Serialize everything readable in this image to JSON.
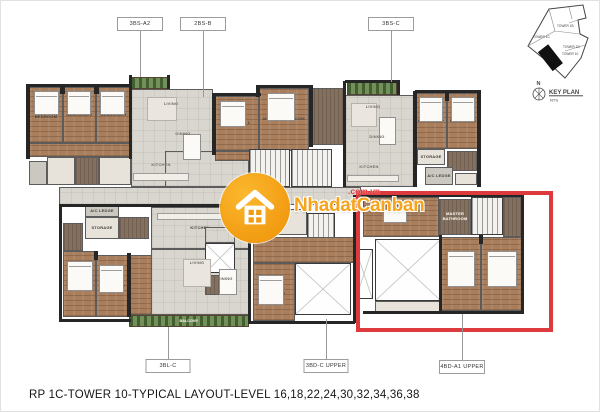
{
  "title": "RP 1C-TOWER 10-TYPICAL LAYOUT-LEVEL 16,18,22,24,30,32,34,36,38",
  "watermark": {
    "name": "NhadatCanban",
    "domain": ".com.vn",
    "circle_color": "#F29C12",
    "text_color": "#F6A41C",
    "domain_color": "#E43438"
  },
  "keyplan": {
    "north": "N",
    "label": "KEY PLAN",
    "scale": "NTS",
    "towers": [
      "TOWER 1B",
      "TOWER 1C",
      "TOWER 1D",
      "TOWER 10"
    ]
  },
  "highlight": {
    "x": 355,
    "y": 190,
    "w": 197,
    "h": 141,
    "color": "#DC3A3D",
    "unit": "4BD-A1 UPPER"
  },
  "unit_labels": [
    {
      "text": "3BS-A2",
      "cx": 139,
      "y": 16,
      "w": 46,
      "h": 14
    },
    {
      "text": "2BS-B",
      "cx": 202,
      "y": 16,
      "w": 46,
      "h": 14
    },
    {
      "text": "3BS-C",
      "cx": 390,
      "y": 16,
      "w": 46,
      "h": 14
    },
    {
      "text": "3BL-C",
      "cx": 167,
      "y": 358,
      "w": 45,
      "h": 14
    },
    {
      "text": "3BD-C UPPER",
      "cx": 325,
      "y": 358,
      "w": 45,
      "h": 14
    },
    {
      "text": "4BD-A1 UPPER",
      "cx": 461,
      "y": 359,
      "w": 46,
      "h": 14
    }
  ],
  "leaders": [
    {
      "x": 139,
      "y1": 30,
      "y2": 76
    },
    {
      "x": 202,
      "y1": 30,
      "y2": 96
    },
    {
      "x": 390,
      "y1": 30,
      "y2": 81
    },
    {
      "x": 167,
      "y1": 326,
      "y2": 358
    },
    {
      "x": 325,
      "y1": 318,
      "y2": 358
    },
    {
      "x": 461,
      "y1": 313,
      "y2": 359
    }
  ],
  "plan": {
    "rooms": [
      {
        "x": 130,
        "y": 76,
        "w": 38,
        "h": 12,
        "type": "balcony"
      },
      {
        "x": 200,
        "y": 101,
        "w": 16,
        "h": 11,
        "type": "balcony"
      },
      {
        "x": 346,
        "y": 81,
        "w": 50,
        "h": 13,
        "type": "balcony"
      },
      {
        "x": 128,
        "y": 314,
        "w": 120,
        "h": 12,
        "type": "balcony",
        "label": "BALCONY"
      },
      {
        "x": 130,
        "y": 88,
        "w": 82,
        "h": 98,
        "type": "tile"
      },
      {
        "x": 344,
        "y": 94,
        "w": 70,
        "h": 92,
        "type": "tile"
      },
      {
        "x": 164,
        "y": 150,
        "w": 84,
        "h": 36,
        "type": "tile"
      },
      {
        "x": 58,
        "y": 186,
        "w": 302,
        "h": 18,
        "type": "tile"
      },
      {
        "x": 150,
        "y": 206,
        "w": 98,
        "h": 42,
        "type": "tile",
        "label": "KITCHEN"
      },
      {
        "x": 150,
        "y": 248,
        "w": 98,
        "h": 66,
        "type": "tile"
      },
      {
        "x": 204,
        "y": 226,
        "w": 30,
        "h": 16,
        "type": "tile"
      },
      {
        "x": 28,
        "y": 86,
        "w": 34,
        "h": 56,
        "type": "wood",
        "label": "MASTER BEDROOM"
      },
      {
        "x": 62,
        "y": 86,
        "w": 33,
        "h": 56,
        "type": "wood",
        "label": "BEDROOM 2"
      },
      {
        "x": 95,
        "y": 86,
        "w": 35,
        "h": 56,
        "type": "wood",
        "label": "BEDROOM 3"
      },
      {
        "x": 28,
        "y": 142,
        "w": 102,
        "h": 14,
        "type": "wood"
      },
      {
        "x": 46,
        "y": 156,
        "w": 28,
        "h": 28,
        "type": "bath"
      },
      {
        "x": 74,
        "y": 156,
        "w": 24,
        "h": 28,
        "type": "dark"
      },
      {
        "x": 98,
        "y": 156,
        "w": 32,
        "h": 28,
        "type": "bath"
      },
      {
        "x": 28,
        "y": 160,
        "w": 18,
        "h": 24,
        "type": "ledge"
      },
      {
        "x": 214,
        "y": 95,
        "w": 44,
        "h": 55,
        "type": "wood",
        "label": "BEDROOM 1"
      },
      {
        "x": 258,
        "y": 87,
        "w": 50,
        "h": 63,
        "type": "wood",
        "label": "MASTER BEDROOM"
      },
      {
        "x": 308,
        "y": 87,
        "w": 36,
        "h": 57,
        "type": "dark"
      },
      {
        "x": 214,
        "y": 150,
        "w": 44,
        "h": 10,
        "type": "wood"
      },
      {
        "x": 248,
        "y": 148,
        "w": 41,
        "h": 38,
        "type": "stairs"
      },
      {
        "x": 290,
        "y": 148,
        "w": 41,
        "h": 38,
        "type": "stairs"
      },
      {
        "x": 414,
        "y": 92,
        "w": 32,
        "h": 56,
        "type": "wood",
        "label": "BEDROOM 2"
      },
      {
        "x": 446,
        "y": 92,
        "w": 32,
        "h": 56,
        "type": "wood",
        "label": "BEDROOM 3"
      },
      {
        "x": 416,
        "y": 148,
        "w": 28,
        "h": 16,
        "type": "bath",
        "label": "STORAGE"
      },
      {
        "x": 446,
        "y": 150,
        "w": 30,
        "h": 20,
        "type": "dark"
      },
      {
        "x": 424,
        "y": 166,
        "w": 28,
        "h": 18,
        "type": "ledge",
        "label": "A/C LEDGE"
      },
      {
        "x": 454,
        "y": 172,
        "w": 22,
        "h": 12,
        "type": "bath"
      },
      {
        "x": 84,
        "y": 204,
        "w": 34,
        "h": 12,
        "type": "ledge",
        "label": "A/C LEDGE"
      },
      {
        "x": 62,
        "y": 222,
        "w": 20,
        "h": 28,
        "type": "dark"
      },
      {
        "x": 84,
        "y": 216,
        "w": 34,
        "h": 22,
        "type": "bath",
        "label": "STORAGE"
      },
      {
        "x": 118,
        "y": 216,
        "w": 30,
        "h": 22,
        "type": "dark"
      },
      {
        "x": 62,
        "y": 250,
        "w": 33,
        "h": 66,
        "type": "wood",
        "label": "BEDROOM 1"
      },
      {
        "x": 95,
        "y": 254,
        "w": 32,
        "h": 62,
        "type": "wood",
        "label": "BEDROOM 2"
      },
      {
        "x": 127,
        "y": 254,
        "w": 24,
        "h": 60,
        "type": "wood"
      },
      {
        "x": 252,
        "y": 208,
        "w": 54,
        "h": 26,
        "type": "bath"
      },
      {
        "x": 306,
        "y": 212,
        "w": 28,
        "h": 30,
        "type": "stairs"
      },
      {
        "x": 252,
        "y": 236,
        "w": 102,
        "h": 26,
        "type": "wood"
      },
      {
        "x": 204,
        "y": 242,
        "w": 30,
        "h": 30,
        "type": "void"
      },
      {
        "x": 204,
        "y": 274,
        "w": 30,
        "h": 20,
        "type": "dark"
      },
      {
        "x": 252,
        "y": 262,
        "w": 42,
        "h": 58,
        "type": "wood",
        "label": "MASTER BEDROOM"
      },
      {
        "x": 294,
        "y": 262,
        "w": 56,
        "h": 52,
        "type": "void"
      },
      {
        "x": 362,
        "y": 196,
        "w": 76,
        "h": 40,
        "type": "wood"
      },
      {
        "x": 438,
        "y": 198,
        "w": 32,
        "h": 36,
        "type": "dark",
        "label": "MASTER BATHROOM"
      },
      {
        "x": 470,
        "y": 196,
        "w": 32,
        "h": 38,
        "type": "stairs"
      },
      {
        "x": 502,
        "y": 196,
        "w": 20,
        "h": 40,
        "type": "dark"
      },
      {
        "x": 354,
        "y": 248,
        "w": 18,
        "h": 50,
        "type": "void"
      },
      {
        "x": 374,
        "y": 238,
        "w": 66,
        "h": 62,
        "type": "void"
      },
      {
        "x": 440,
        "y": 236,
        "w": 40,
        "h": 74,
        "type": "wood",
        "label": "MASTER BEDROOM"
      },
      {
        "x": 480,
        "y": 236,
        "w": 42,
        "h": 74,
        "type": "wood",
        "label": "BEDROOM 4"
      },
      {
        "x": 374,
        "y": 300,
        "w": 66,
        "h": 12,
        "type": "bath"
      }
    ],
    "text_tags": [
      {
        "x": 146,
        "y": 96,
        "w": 48,
        "h": 14,
        "type": "none",
        "label": "LIVING"
      },
      {
        "x": 158,
        "y": 126,
        "w": 48,
        "h": 14,
        "type": "none",
        "label": "DINING"
      },
      {
        "x": 136,
        "y": 158,
        "w": 48,
        "h": 12,
        "type": "none",
        "label": "KITCHEN"
      },
      {
        "x": 352,
        "y": 100,
        "w": 40,
        "h": 12,
        "type": "none",
        "label": "LIVING"
      },
      {
        "x": 356,
        "y": 130,
        "w": 40,
        "h": 12,
        "type": "none",
        "label": "DINING"
      },
      {
        "x": 348,
        "y": 160,
        "w": 40,
        "h": 12,
        "type": "none",
        "label": "KITCHEN"
      },
      {
        "x": 176,
        "y": 256,
        "w": 40,
        "h": 12,
        "type": "none",
        "label": "LIVING"
      },
      {
        "x": 204,
        "y": 272,
        "w": 40,
        "h": 12,
        "type": "none",
        "label": "DINING"
      }
    ],
    "walls": [
      {
        "x": 25,
        "y": 83,
        "w": 4,
        "h": 75
      },
      {
        "x": 25,
        "y": 83,
        "w": 106,
        "h": 3
      },
      {
        "x": 59,
        "y": 84,
        "w": 5,
        "h": 9
      },
      {
        "x": 93,
        "y": 84,
        "w": 5,
        "h": 9
      },
      {
        "x": 128,
        "y": 74,
        "w": 3,
        "h": 84
      },
      {
        "x": 166,
        "y": 74,
        "w": 3,
        "h": 14
      },
      {
        "x": 211,
        "y": 92,
        "w": 4,
        "h": 62
      },
      {
        "x": 212,
        "y": 92,
        "w": 48,
        "h": 3
      },
      {
        "x": 256,
        "y": 84,
        "w": 56,
        "h": 3
      },
      {
        "x": 255,
        "y": 84,
        "w": 4,
        "h": 12
      },
      {
        "x": 308,
        "y": 84,
        "w": 4,
        "h": 62
      },
      {
        "x": 342,
        "y": 80,
        "w": 3,
        "h": 106
      },
      {
        "x": 344,
        "y": 79,
        "w": 54,
        "h": 3
      },
      {
        "x": 396,
        "y": 79,
        "w": 3,
        "h": 15
      },
      {
        "x": 412,
        "y": 90,
        "w": 4,
        "h": 96
      },
      {
        "x": 414,
        "y": 89,
        "w": 66,
        "h": 3
      },
      {
        "x": 444,
        "y": 90,
        "w": 4,
        "h": 10
      },
      {
        "x": 476,
        "y": 89,
        "w": 4,
        "h": 97
      },
      {
        "x": 58,
        "y": 203,
        "w": 3,
        "h": 118
      },
      {
        "x": 59,
        "y": 203,
        "w": 190,
        "h": 3
      },
      {
        "x": 60,
        "y": 318,
        "w": 70,
        "h": 3
      },
      {
        "x": 247,
        "y": 203,
        "w": 3,
        "h": 120
      },
      {
        "x": 93,
        "y": 250,
        "w": 4,
        "h": 9
      },
      {
        "x": 126,
        "y": 252,
        "w": 4,
        "h": 64
      },
      {
        "x": 250,
        "y": 320,
        "w": 104,
        "h": 3
      },
      {
        "x": 352,
        "y": 194,
        "w": 3,
        "h": 128
      },
      {
        "x": 360,
        "y": 193,
        "w": 163,
        "h": 3
      },
      {
        "x": 520,
        "y": 193,
        "w": 3,
        "h": 120
      },
      {
        "x": 362,
        "y": 310,
        "w": 160,
        "h": 3
      },
      {
        "x": 438,
        "y": 234,
        "w": 3,
        "h": 78
      },
      {
        "x": 478,
        "y": 234,
        "w": 4,
        "h": 9
      }
    ],
    "furniture": [
      {
        "type": "bed",
        "x": 33,
        "y": 90,
        "w": 25,
        "h": 24
      },
      {
        "type": "bed",
        "x": 66,
        "y": 90,
        "w": 24,
        "h": 24
      },
      {
        "type": "bed",
        "x": 99,
        "y": 90,
        "w": 25,
        "h": 24
      },
      {
        "type": "bed",
        "x": 219,
        "y": 100,
        "w": 26,
        "h": 26
      },
      {
        "type": "bed",
        "x": 266,
        "y": 92,
        "w": 28,
        "h": 28
      },
      {
        "type": "bed",
        "x": 418,
        "y": 96,
        "w": 24,
        "h": 25
      },
      {
        "type": "bed",
        "x": 450,
        "y": 96,
        "w": 24,
        "h": 25
      },
      {
        "type": "bed",
        "x": 66,
        "y": 260,
        "w": 26,
        "h": 30
      },
      {
        "type": "bed",
        "x": 98,
        "y": 264,
        "w": 25,
        "h": 28
      },
      {
        "type": "bed",
        "x": 257,
        "y": 274,
        "w": 26,
        "h": 30
      },
      {
        "type": "bed",
        "x": 446,
        "y": 250,
        "w": 28,
        "h": 36
      },
      {
        "type": "bed",
        "x": 486,
        "y": 250,
        "w": 30,
        "h": 36
      },
      {
        "type": "table",
        "x": 182,
        "y": 133,
        "w": 18,
        "h": 26
      },
      {
        "type": "table",
        "x": 378,
        "y": 116,
        "w": 17,
        "h": 28
      },
      {
        "type": "table",
        "x": 218,
        "y": 268,
        "w": 18,
        "h": 26
      },
      {
        "type": "table",
        "x": 382,
        "y": 208,
        "w": 24,
        "h": 14
      },
      {
        "type": "rug",
        "x": 146,
        "y": 96,
        "w": 30,
        "h": 24
      },
      {
        "type": "rug",
        "x": 350,
        "y": 102,
        "w": 26,
        "h": 24
      },
      {
        "type": "rug",
        "x": 182,
        "y": 258,
        "w": 28,
        "h": 28
      },
      {
        "type": "counter",
        "x": 132,
        "y": 172,
        "w": 56,
        "h": 8
      },
      {
        "type": "counter",
        "x": 156,
        "y": 212,
        "w": 66,
        "h": 7
      },
      {
        "type": "counter",
        "x": 346,
        "y": 174,
        "w": 52,
        "h": 7
      }
    ]
  }
}
